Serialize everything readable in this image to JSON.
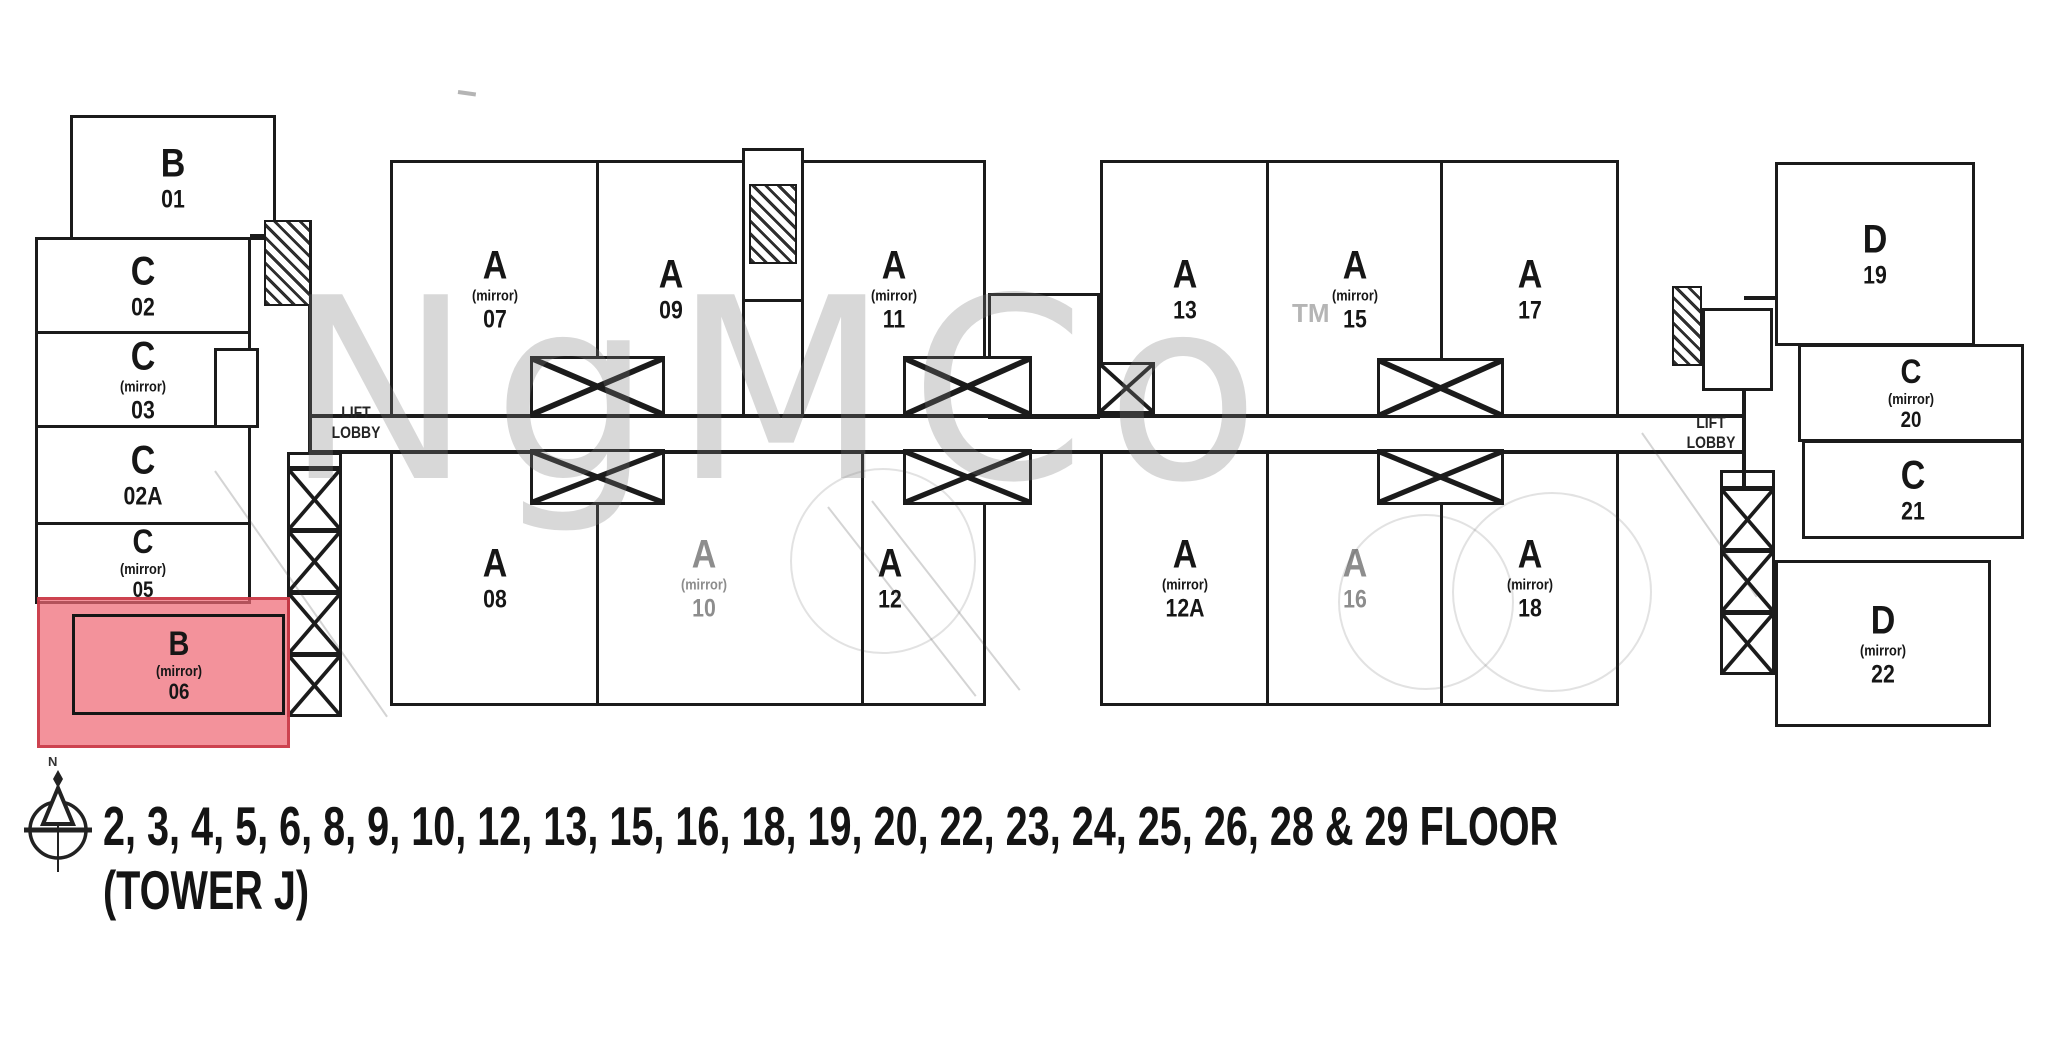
{
  "watermark": {
    "text": "NgMCo",
    "tm": "TM"
  },
  "caption": {
    "line1": "2, 3, 4, 5, 6, 8, 9, 10, 12, 13, 15, 16, 18, 19, 20, 22, 23, 24, 25, 26, 28 & 29 FLOOR",
    "line2": "(TOWER J)"
  },
  "compass": {
    "label": "N",
    "icon": "compass-north-icon"
  },
  "lift_lobby": {
    "line1": "LIFT",
    "line2": "LOBBY"
  },
  "colors": {
    "highlight_fill": "#ee6874",
    "highlight_border": "#c63442",
    "line": "#1b1b1b"
  },
  "units": {
    "b01": {
      "type": "B",
      "number": "01"
    },
    "c02": {
      "type": "C",
      "number": "02"
    },
    "c03": {
      "type": "C",
      "mirror": "(mirror)",
      "number": "03"
    },
    "c02a": {
      "type": "C",
      "number": "02A"
    },
    "c05": {
      "type": "C",
      "mirror": "(mirror)",
      "number": "05"
    },
    "b06": {
      "type": "B",
      "mirror": "(mirror)",
      "number": "06"
    },
    "a07": {
      "type": "A",
      "mirror": "(mirror)",
      "number": "07"
    },
    "a09": {
      "type": "A",
      "number": "09"
    },
    "a11": {
      "type": "A",
      "mirror": "(mirror)",
      "number": "11"
    },
    "a08": {
      "type": "A",
      "number": "08"
    },
    "a10": {
      "type": "A",
      "mirror": "(mirror)",
      "number": "10"
    },
    "a12": {
      "type": "A",
      "number": "12"
    },
    "a13": {
      "type": "A",
      "number": "13"
    },
    "a15": {
      "type": "A",
      "mirror": "(mirror)",
      "number": "15"
    },
    "a17": {
      "type": "A",
      "number": "17"
    },
    "a12a": {
      "type": "A",
      "mirror": "(mirror)",
      "number": "12A"
    },
    "a16": {
      "type": "A",
      "number": "16"
    },
    "a18": {
      "type": "A",
      "mirror": "(mirror)",
      "number": "18"
    },
    "d19": {
      "type": "D",
      "number": "19"
    },
    "c20": {
      "type": "C",
      "mirror": "(mirror)",
      "number": "20"
    },
    "c21": {
      "type": "C",
      "number": "21"
    },
    "d22": {
      "type": "D",
      "mirror": "(mirror)",
      "number": "22"
    }
  }
}
